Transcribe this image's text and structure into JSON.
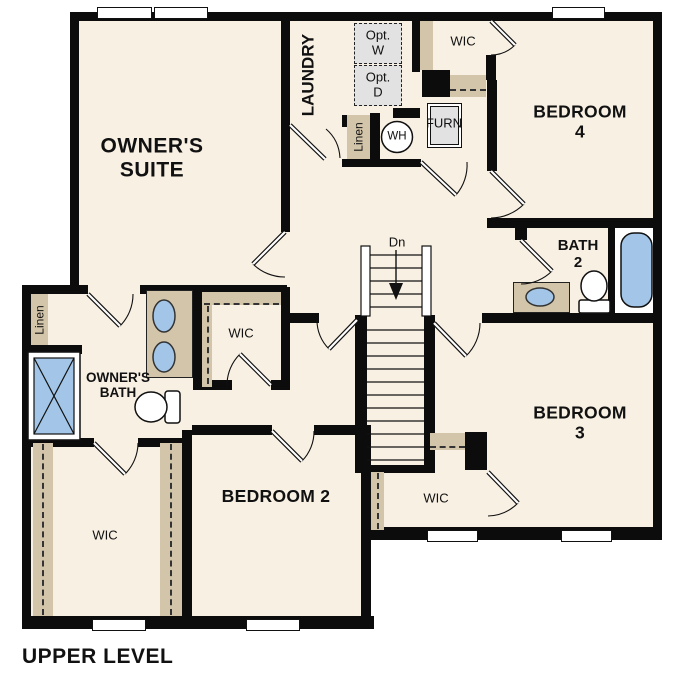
{
  "title": "UPPER LEVEL",
  "colors": {
    "floor": "#f8f0e3",
    "wall": "#0c0c0c",
    "shelf_tan": "#d3c5a9",
    "fixture_blue": "#a3c6e8",
    "optional_gray": "#e2e2e2"
  },
  "rooms": {
    "owners_suite": {
      "label": "OWNER'S\nSUITE"
    },
    "laundry": {
      "label": "LAUNDRY"
    },
    "bedroom2": {
      "label": "BEDROOM 2"
    },
    "bedroom3": {
      "label": "BEDROOM 3"
    },
    "bedroom4": {
      "label": "BEDROOM 4"
    },
    "bath2": {
      "label": "BATH\n2"
    },
    "owners_bath": {
      "label": "OWNER'S\nBATH"
    },
    "wic_bedroom4": {
      "label": "WIC"
    },
    "wic_owners": {
      "label": "WIC"
    },
    "wic_bedroom2": {
      "label": "WIC"
    },
    "wic_bedroom3": {
      "label": "WIC"
    },
    "linen_hall": {
      "label": "Linen"
    },
    "linen_laundry": {
      "label": "Linen"
    }
  },
  "fixtures": {
    "stairs": "Dn",
    "water_heater": "WH",
    "furnace": "FURN",
    "opt_washer": "Opt.\nW",
    "opt_dryer": "Opt.\nD"
  }
}
